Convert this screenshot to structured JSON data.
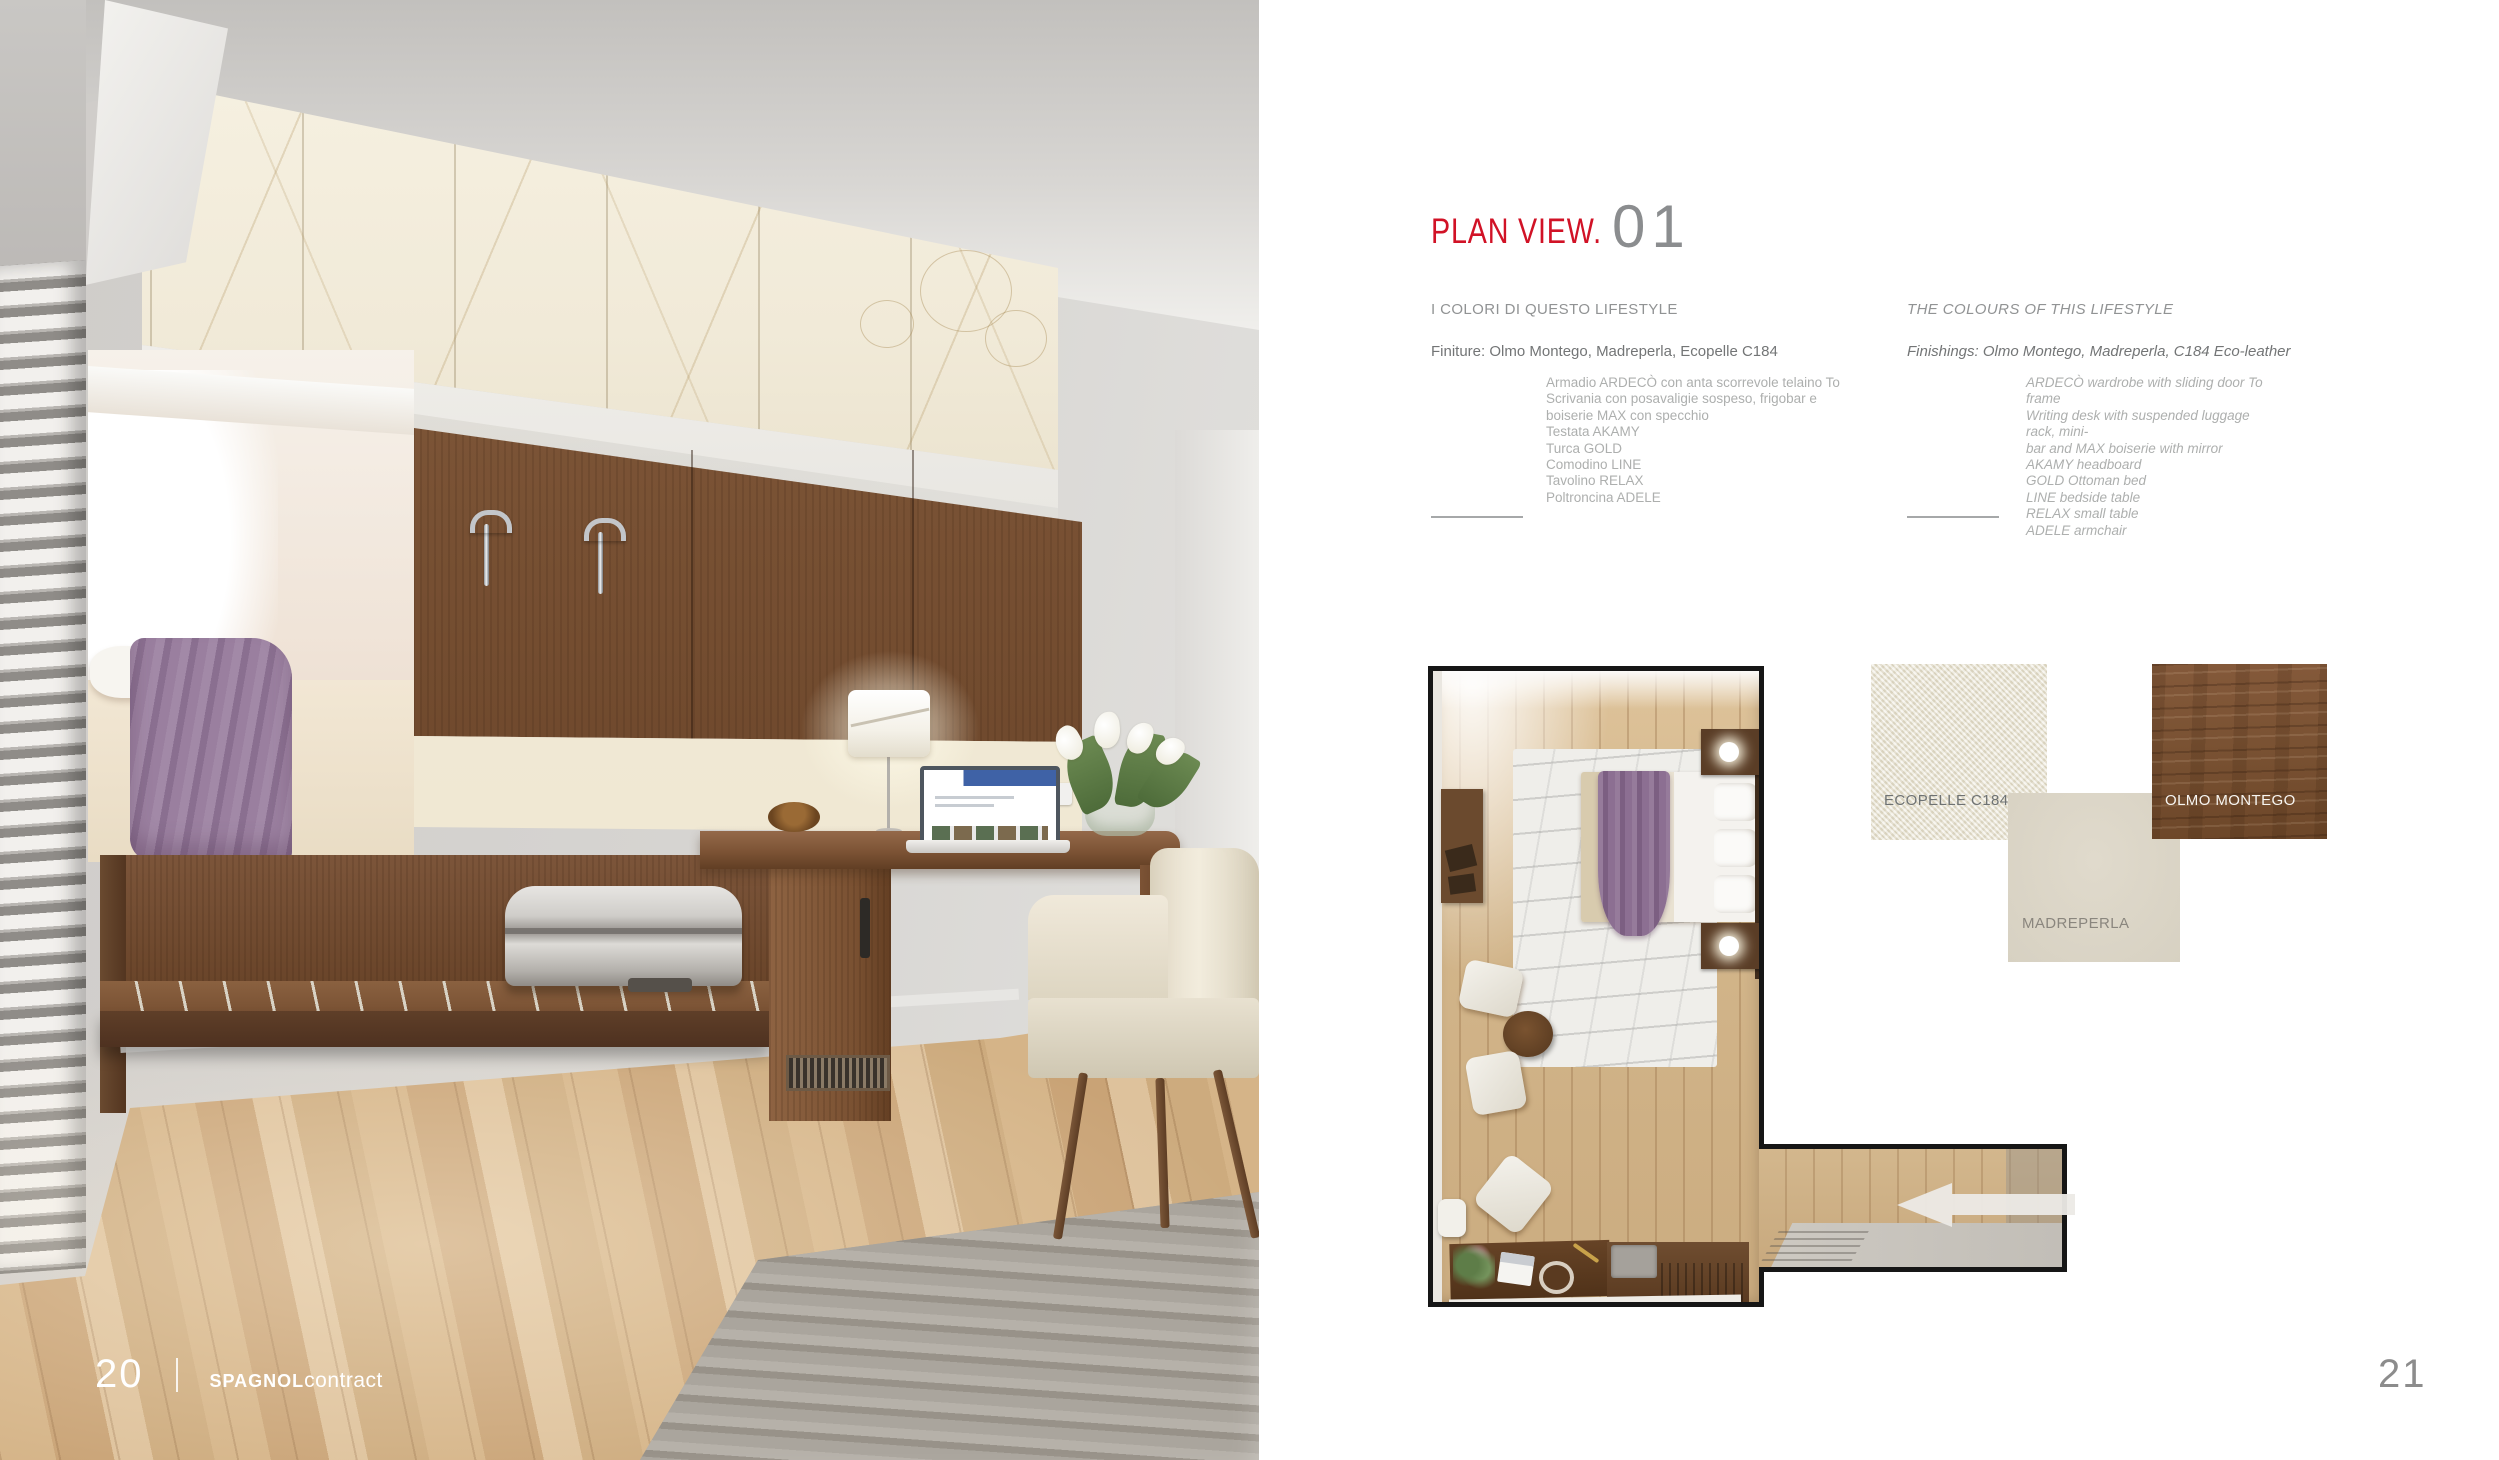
{
  "theme": {
    "accent_red": "#d11226",
    "number_gray": "#8b8d8f",
    "head_gray": "#919394",
    "sub_gray": "#737576",
    "list_gray": "#adafae",
    "rule_gray": "#a6a8a9",
    "wood_dark": "#7d5634",
    "cream": "#e9e4d4",
    "madreperla": "#dcd6c8",
    "plan_border": "#161616",
    "page_bg": "#ffffff"
  },
  "left_page": {
    "page_number": "20",
    "brand_strong": "SPAGNOL",
    "brand_light": "contract"
  },
  "right_page": {
    "title": "PLAN VIEW.",
    "title_number": "01",
    "col_it": {
      "header": "I COLORI DI QUESTO LIFESTYLE",
      "finishes": "Finiture: Olmo Montego, Madreperla, Ecopelle C184",
      "items": [
        "Armadio ARDECÒ con anta scorrevole telaino To",
        "Scrivania con posavaligie sospeso, frigobar e",
        "boiserie MAX con specchio",
        "Testata AKAMY",
        "Turca GOLD",
        "Comodino LINE",
        "Tavolino RELAX",
        "Poltroncina ADELE"
      ]
    },
    "col_en": {
      "header": "THE COLOURS OF THIS LIFESTYLE",
      "finishes": "Finishings: Olmo Montego, Madreperla, C184 Eco-leather",
      "items": [
        "ARDECÒ wardrobe with sliding door To frame",
        "Writing desk with suspended luggage rack, mini-",
        "bar and MAX boiserie with mirror",
        "AKAMY headboard",
        "GOLD Ottoman bed",
        "LINE bedside table",
        "RELAX small table",
        "ADELE armchair"
      ]
    },
    "swatches": [
      {
        "label": "ECOPELLE C184"
      },
      {
        "label": "MADREPERLA"
      },
      {
        "label": "OLMO MONTEGO"
      }
    ],
    "page_number": "21"
  }
}
